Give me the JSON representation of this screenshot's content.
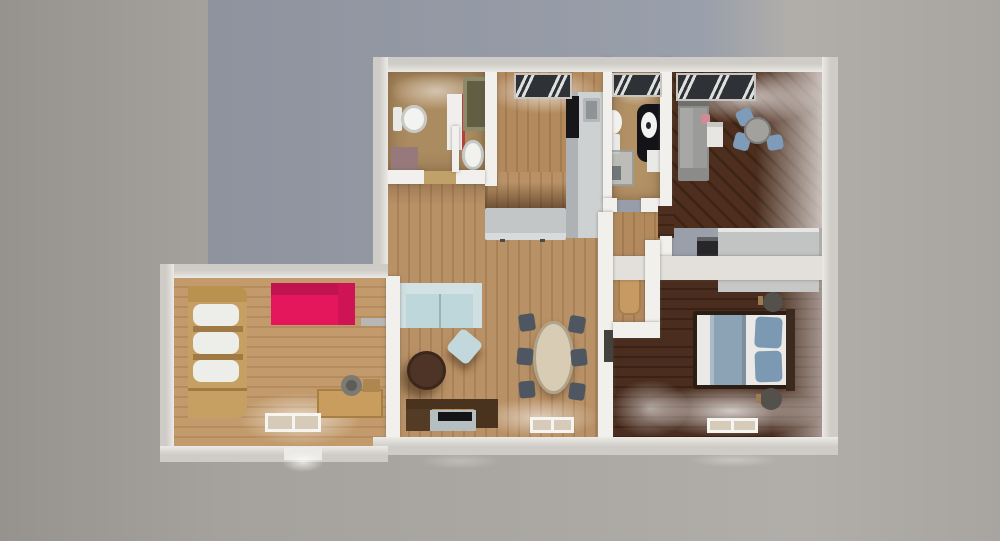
{
  "scene": {
    "type": "3d_floorplan_aerial_render",
    "units": "apartment with two bedrooms, two bathrooms, kitchen hall, living room and studio wing"
  },
  "background": {
    "base_left": "#96938e",
    "base_mid": "#aba8a3",
    "base_right": "#b1aeaa",
    "panel_left": "#8e939e",
    "panel_right": "#9aa0ab"
  },
  "walls": {
    "exterior_dark": "#cfccc7",
    "exterior_light": "#eceae6",
    "interior": "#f2f0ec",
    "interior_dim": "#e3e0db"
  },
  "openings": {
    "window_frame": "#f6f5f2",
    "window_glass": "#d5cbb8",
    "roof_window_dark": "#2e3237",
    "roof_window_grille": "#dfe0de",
    "front_door": "#eceae6",
    "dark_door": "#44423e",
    "threshold": "#c0a169"
  },
  "rooms": {
    "bathroom_main": {
      "label": "main bathroom",
      "floor": "#ab8b60",
      "toilet": "#f3f3f1",
      "tank": "#e9e9e7",
      "vanity": "#f0efed",
      "vanity_accent": "#b8403c",
      "mat": "#97797c",
      "second_toilet": "#f1f1ef",
      "closet_frame": "#8d8a6a",
      "closet_interior": "#615e44"
    },
    "kitchen_hall": {
      "label": "kitchen / entry hall",
      "floor": [
        "#b28a5e",
        "#a47b4f"
      ],
      "counter": "#c3c6c7",
      "counter_front": "#d8dadb",
      "counter_tall": "#aeb2b4",
      "counter_top": "#ced1d2",
      "oven": "#17171a",
      "sink": "#8e9396",
      "sink_inner": "#767b7e"
    },
    "bathroom_small": {
      "label": "small bathroom",
      "floor": "#b29165",
      "toilet": "#f1f1ef",
      "tank": "#e9e9e7",
      "vanity": "#141318",
      "sink": "#f2f2f0",
      "washer": "#e9e9e7",
      "shower_glass": "#bfc5c7",
      "shower_drain": "#70767a"
    },
    "bedroom_top": {
      "label": "top bedroom",
      "floor": [
        "#4e2f1f",
        "#3d2414"
      ],
      "bed": "#8b8b89",
      "headboard": "#6f6f6d",
      "blanket": "#9b9b99",
      "pillow": "#d08a95",
      "nightstand": "#e8e6e2",
      "dresser": "#9c9c9a",
      "table": "#a2a19d",
      "chair": "#7e9bba",
      "sideboard": "#c2c4c3",
      "sideboard_top": "#e5e6e5",
      "cabinet_dark": "#27272a"
    },
    "hallway": {
      "label": "hallway",
      "floor": [
        "#b28a5e",
        "#a47b4f"
      ],
      "bench": "#c79a63"
    },
    "bedroom_right": {
      "label": "right bedroom",
      "floor": [
        "#4a2d1e",
        "#3a2215"
      ],
      "bed_frame": "#2b1e14",
      "mattress": "#eae9e6",
      "blanket": "#8ca3b6",
      "pillow": "#7b99b2",
      "headboard": "#3a2b1e",
      "nightstand": "#54504b",
      "nightstand_wood": "#9c7b52",
      "wardrobe": "#c6c8c7"
    },
    "living": {
      "label": "living room",
      "floor": [
        "#b99166",
        "#aa8257"
      ],
      "sofa": "#bed7db",
      "sofa_back": "#d2e1e4",
      "sofa_arm": "#cfdfe2",
      "ottoman": "#c2d8dc",
      "coffee_table": "#4d3426",
      "tv_unit": "#49331f",
      "tv_unit_light": "#543b26",
      "tv_base": "#b5bfc1",
      "tv": "#141414",
      "table": "#d9ccb5",
      "chair": "#4d5661"
    },
    "left_room": {
      "label": "studio wing",
      "floor": [
        "#c29a6b",
        "#b48c5e"
      ],
      "shelving": "#c6a062",
      "shelving_dark": "#b9924f",
      "shelf_rolls": "#ededea",
      "shelf_edge": "#a07a45",
      "sofa": "#e4175c",
      "sofa_back": "#c11350",
      "sofa_arm": "#cf1456",
      "desk": "#c89d5e",
      "bowl": "#7d7973",
      "bowl_inner": "#5f5b56",
      "tray": "#ad8750",
      "wall_shelf": "#b9b7b3"
    }
  }
}
